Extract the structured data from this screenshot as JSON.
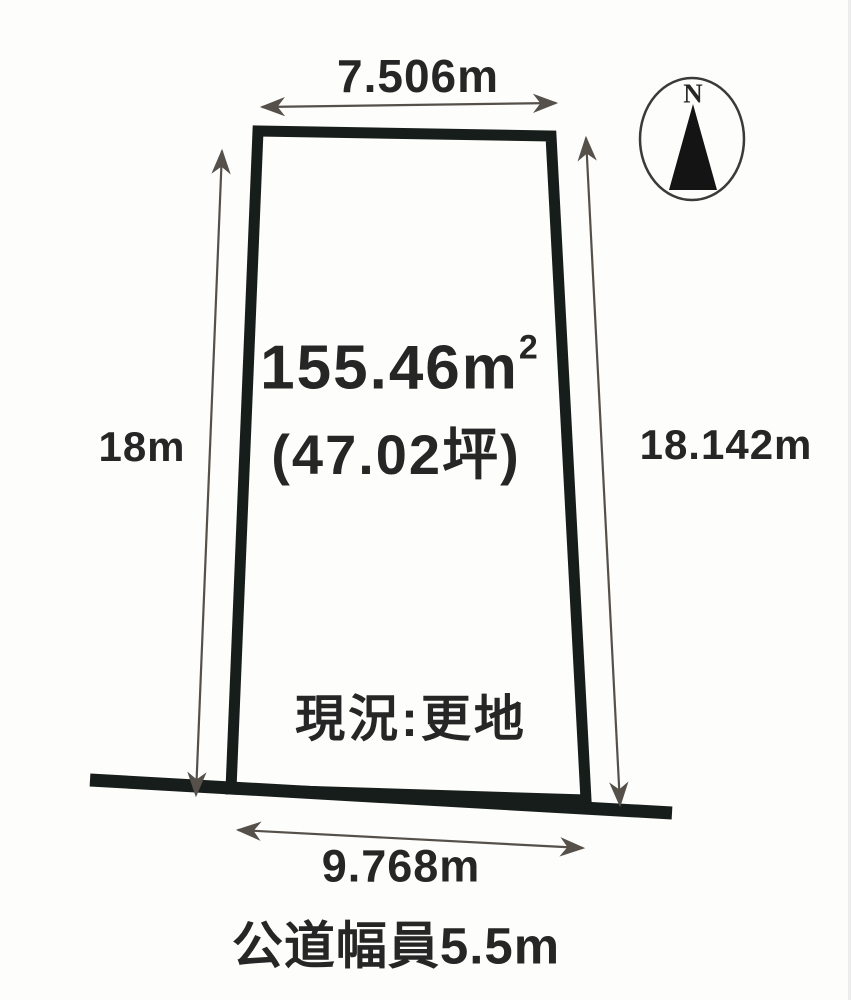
{
  "colors": {
    "ink": "#262626",
    "parcel_border": "#171d1a",
    "road_line": "#171d1a",
    "arrow": "#55504a",
    "background": "#fdfdfb"
  },
  "compass": {
    "label": "N"
  },
  "dims": {
    "top": "7.506m",
    "left": "18m",
    "right": "18.142m",
    "frontage": "9.768m"
  },
  "parcel": {
    "area_sqm": "155.46m",
    "area_sqm_sup": "2",
    "area_tsubo": "(47.02坪)",
    "status": "現況:更地"
  },
  "road": {
    "width_label": "公道幅員5.5m"
  }
}
